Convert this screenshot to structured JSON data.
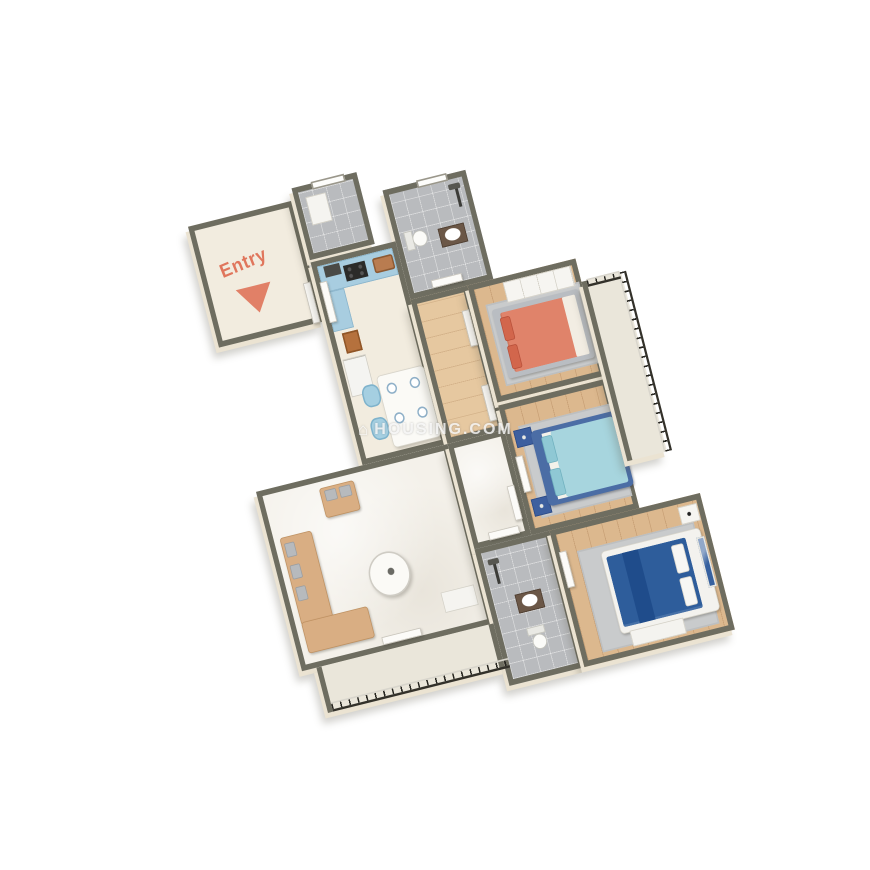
{
  "scene": {
    "description": "3D isometric floor plan render of a three-bedroom apartment",
    "background_color": "#ffffff",
    "entry_label": "Entry",
    "entry_arrow_color": "#e0765c"
  },
  "watermark": {
    "icon_glyph": "⌂",
    "text": "HOUSING.COM",
    "opacity": 0.78
  },
  "palette": {
    "wall_top": "#6e6d60",
    "wall_face": "#ebe3d2",
    "floor_cream": "#f2ecdf",
    "floor_marble": "#f4f1ea",
    "floor_wood": "#dcb88e",
    "floor_tile": "#b9bbbe",
    "kitchen_cabinet": "#a8cde0",
    "coral_bed": "#e0836a",
    "teal_bed": "#a7d5de",
    "blue_frame": "#4b6da5",
    "navy_bed": "#2e5d9b",
    "sofa_tan": "#d9ae83",
    "rug_gray": "#c9cbcc",
    "railing_iron": "#262520",
    "doormat": "#b5713d"
  },
  "rooms": [
    {
      "id": "entry-foyer",
      "furniture": [
        "entry-label",
        "entry-arrow"
      ]
    },
    {
      "id": "utility",
      "furniture": [
        "washer",
        "window"
      ]
    },
    {
      "id": "bathroom-1",
      "furniture": [
        "shower",
        "vanity-sink",
        "toilet",
        "window",
        "door"
      ]
    },
    {
      "id": "kitchen-dining",
      "furniture": [
        "l-counter",
        "range-hood",
        "cooktop",
        "sink",
        "refrigerator",
        "entry-door",
        "doormat",
        "dining-table",
        "4 plates",
        "4 chairs"
      ]
    },
    {
      "id": "hallway-1",
      "furniture": [
        "door-bedroom-1",
        "door-bedroom-2"
      ]
    },
    {
      "id": "bedroom-1",
      "furniture": [
        "double-bed-coral",
        "2 pillows",
        "rug",
        "wardrobe",
        "door"
      ]
    },
    {
      "id": "bedroom-2",
      "furniture": [
        "double-bed-teal",
        "2 pillows",
        "2 nightstands",
        "rug",
        "door"
      ]
    },
    {
      "id": "balcony-1",
      "furniture": [
        "iron-railing"
      ]
    },
    {
      "id": "living-room",
      "furniture": [
        "armchair",
        "l-sofa",
        "cushions",
        "coffee-table",
        "cabinet",
        "balcony-door"
      ]
    },
    {
      "id": "hallway-2",
      "furniture": [
        "door-bedroom-3",
        "door-bathroom-2"
      ]
    },
    {
      "id": "bathroom-2",
      "furniture": [
        "shower",
        "vanity-sink",
        "toilet",
        "door"
      ]
    },
    {
      "id": "bedroom-3",
      "furniture": [
        "double-bed-navy",
        "2 pillows",
        "wall-art",
        "nightstand",
        "dresser",
        "rug",
        "door"
      ]
    },
    {
      "id": "living-balcony",
      "furniture": [
        "iron-railing"
      ]
    }
  ]
}
